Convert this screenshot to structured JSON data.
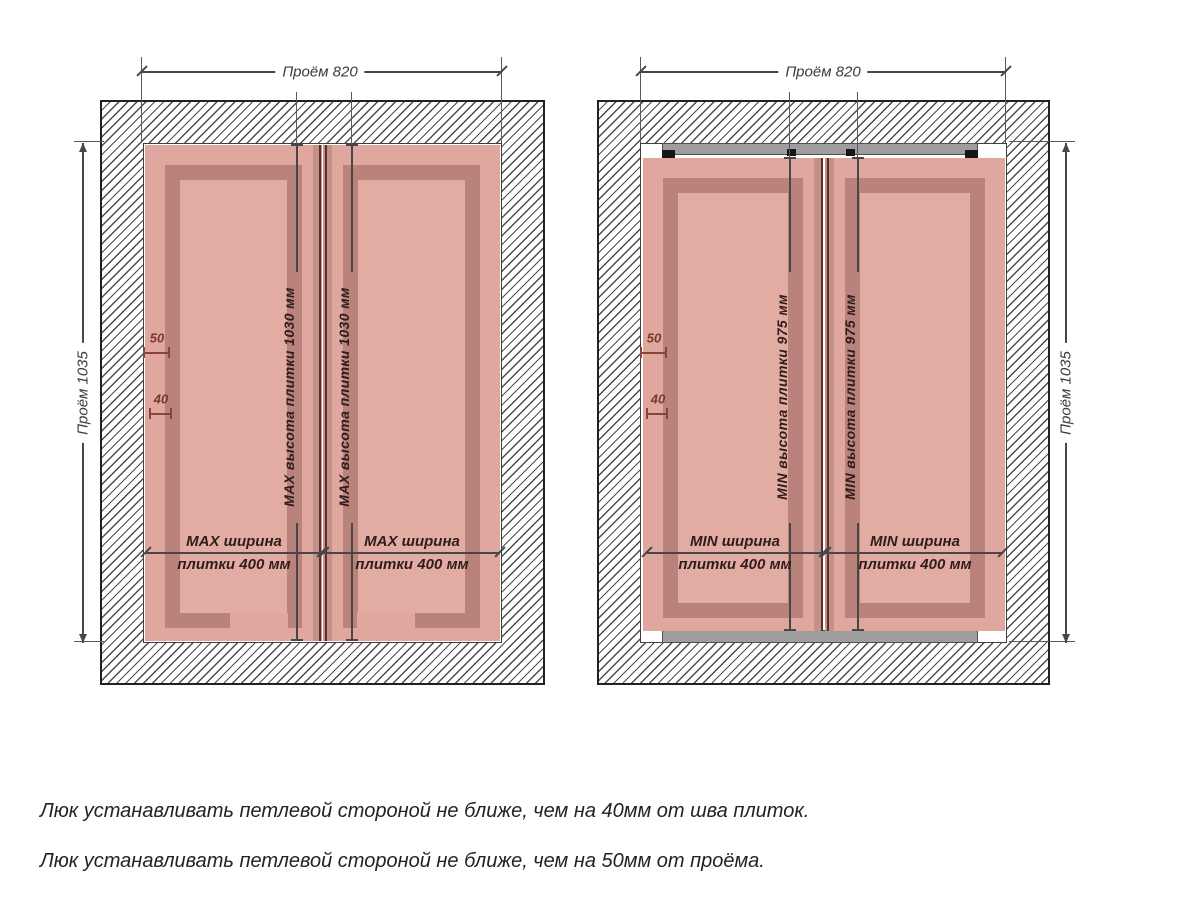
{
  "diagrams": {
    "left": {
      "opening_width_label": "Проём 820",
      "opening_height_label": "Проём 1035",
      "tile_height_label": "MAX высота плитки 1030 мм",
      "tile_width_line1": "MAX ширина",
      "tile_width_line2": "плитки 400 мм",
      "offset_hinge_label": "50",
      "offset_seam_label": "40"
    },
    "right": {
      "opening_width_label": "Проём 820",
      "opening_height_label": "Проём 1035",
      "tile_height_label": "MIN высота плитки 975 мм",
      "tile_width_line1": "MIN ширина",
      "tile_width_line2": "плитки 400 мм",
      "offset_hinge_label": "50",
      "offset_seam_label": "40"
    }
  },
  "notes": {
    "line1": "Люк устанавливать петлевой стороной не ближе, чем на 40мм от шва плиток.",
    "line2": "Люк устанавливать петлевой стороной не ближе, чем на 50мм от проёма."
  },
  "colors": {
    "tile_pink": "#dfa79e",
    "frame_pink": "#b9837b",
    "panel_pink": "#e3aca3",
    "seam_stripe": "#c49189",
    "seam_line": "#5e2c2a",
    "metal_gray": "#9d9d9d",
    "metal_border": "#505050",
    "mark_black": "#161616",
    "dim_gray": "#474747",
    "text_gray": "#3c3c3c",
    "tile_text": "#2e1d1b",
    "maroon": "#7c372c",
    "hatch_line": "#4c4c4c",
    "wall_border": "#212121"
  }
}
